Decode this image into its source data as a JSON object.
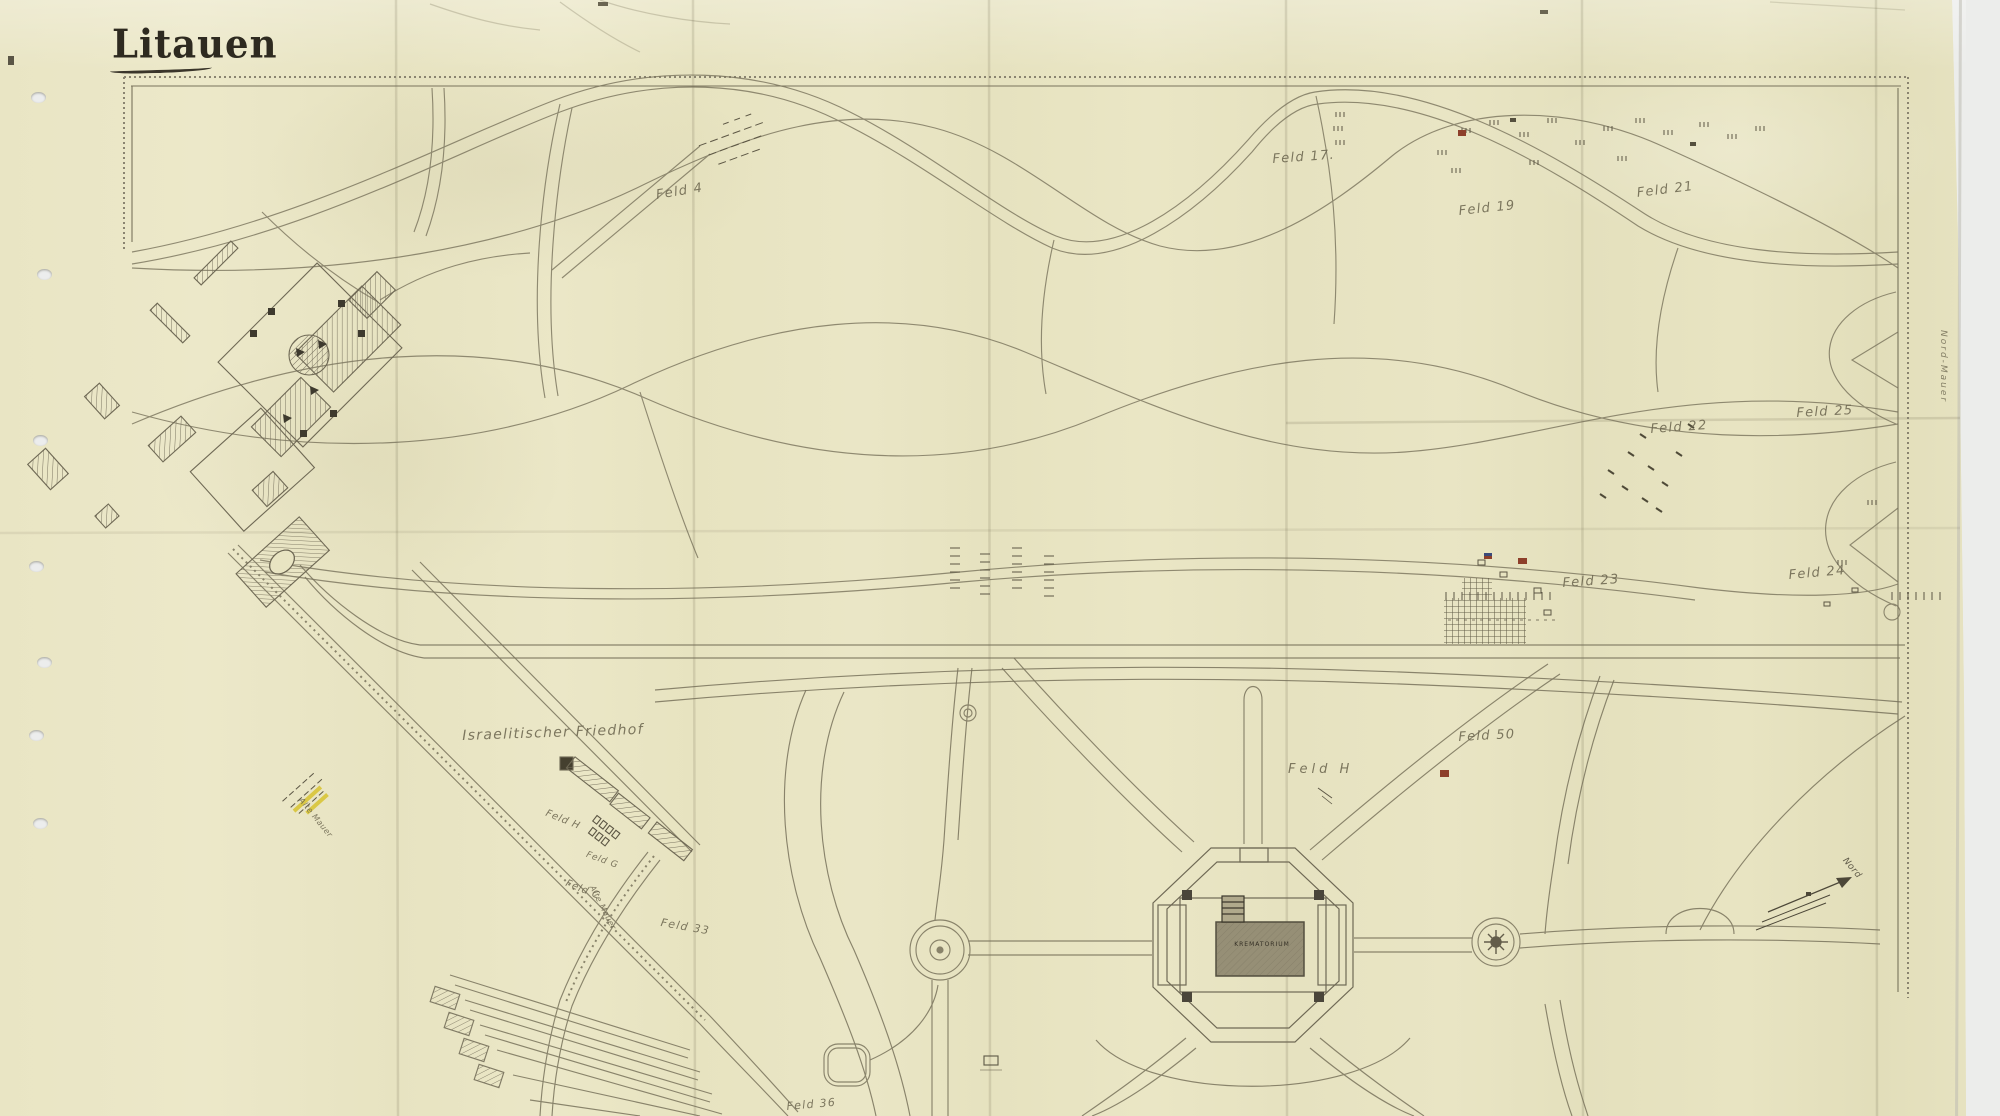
{
  "map": {
    "title": "Litauen",
    "fields": {
      "f4": "Feld 4",
      "f17": "Feld 17.",
      "f19": "Feld 19",
      "f21": "Feld 21",
      "f22": "Feld 22",
      "f23": "Feld 23",
      "f24": "Feld 24",
      "f25": "Feld 25",
      "f50": "Feld 50",
      "fH_right": "Feld H",
      "fH_left": "Feld H",
      "fG": "Feld G",
      "fC": "Feld C",
      "f33": "Feld 33",
      "f36": "Feld 36"
    },
    "places": {
      "jewish_cemetery": "Israelitischer Friedhof",
      "crematorium": "KREMATORIUM",
      "north_wall": "Nord-Mauer",
      "old_wall": "Alte Mauer",
      "compass_north": "Nord"
    },
    "colors": {
      "paper": "#e8e4c2",
      "ink": "#6f6955",
      "red_marker": "#8d3f2a",
      "blue_marker": "#3a4a7a",
      "yellow_marker": "#d9c63e",
      "background": "#e9eae8"
    }
  }
}
